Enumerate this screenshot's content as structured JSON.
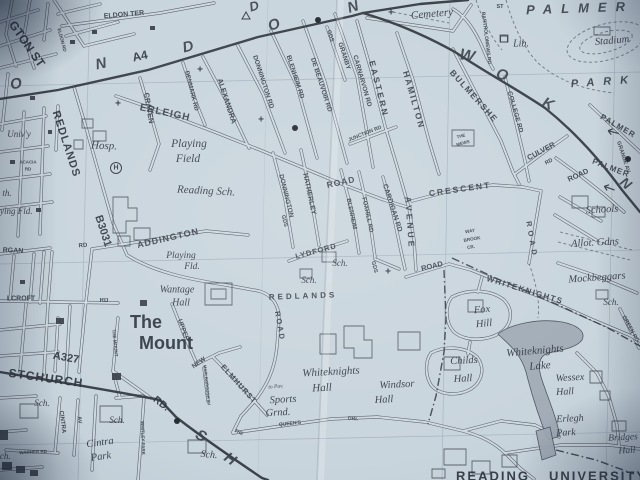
{
  "map": {
    "kind": "paper-street-atlas-photo",
    "area": "Reading - Whiteknights / University district",
    "colors": {
      "paper": "#c8d5de",
      "ink": "#3c434d",
      "bold_road": "#343a43",
      "lake": "#a9b5c1"
    },
    "road_numbers": [
      "A4",
      "B3031",
      "A327"
    ],
    "labels": [
      {
        "t": "GTON ST",
        "x": 27,
        "y": 44,
        "s": 12,
        "r": 55,
        "c": "plb"
      },
      {
        "t": "ELDON TER",
        "x": 124,
        "y": 15,
        "s": 7,
        "r": -5,
        "c": "st"
      },
      {
        "t": "ELDON RD",
        "x": 62,
        "y": 40,
        "s": 4.6,
        "r": 75,
        "c": "st"
      },
      {
        "t": "REDLANDS",
        "x": 66,
        "y": 144,
        "s": 11,
        "r": 72,
        "c": "plb",
        "ls": 1
      },
      {
        "t": "B3031",
        "x": 103,
        "y": 231,
        "s": 11,
        "r": 72,
        "c": "num"
      },
      {
        "t": "CRAVEN",
        "x": 149,
        "y": 108,
        "s": 7.5,
        "r": 80,
        "c": "st"
      },
      {
        "t": "ERLEIGH",
        "x": 165,
        "y": 113,
        "s": 10,
        "r": 12,
        "c": "st",
        "ls": 1
      },
      {
        "t": "DENMARK RD",
        "x": 191,
        "y": 91,
        "s": 6,
        "r": 76,
        "c": "st"
      },
      {
        "t": "ALEXANDRA",
        "x": 227,
        "y": 101,
        "s": 7.5,
        "r": 72,
        "c": "st"
      },
      {
        "t": "DONNINGTON RD",
        "x": 263,
        "y": 82,
        "s": 6.5,
        "r": 72,
        "c": "st"
      },
      {
        "t": "BLENHEIM RD",
        "x": 295,
        "y": 77,
        "s": 6.5,
        "r": 72,
        "c": "st"
      },
      {
        "t": "DE BEAUVOIR RD",
        "x": 321,
        "y": 85,
        "s": 6.5,
        "r": 72,
        "c": "st"
      },
      {
        "t": "GDS",
        "x": 330,
        "y": 36,
        "s": 5.5,
        "r": 72,
        "c": "st"
      },
      {
        "t": "GRANBY",
        "x": 344,
        "y": 56,
        "s": 6.5,
        "r": 72,
        "c": "st"
      },
      {
        "t": "CARNARVON RD",
        "x": 362,
        "y": 81,
        "s": 6.5,
        "r": 74,
        "c": "st"
      },
      {
        "t": "EASTERN",
        "x": 379,
        "y": 89,
        "s": 8.5,
        "r": 76,
        "c": "st",
        "ls": 2.5
      },
      {
        "t": "AVENUE",
        "x": 410,
        "y": 223,
        "s": 8.5,
        "r": 86,
        "c": "st",
        "ls": 3
      },
      {
        "t": "HAMILTON",
        "x": 414,
        "y": 100,
        "s": 8.5,
        "r": 74,
        "c": "st",
        "ls": 2
      },
      {
        "t": "JUNCTION RD",
        "x": 365,
        "y": 134,
        "s": 5.2,
        "r": -22,
        "c": "st"
      },
      {
        "t": "BULMERSHE",
        "x": 474,
        "y": 96,
        "s": 8.5,
        "r": 48,
        "c": "st",
        "ls": 1.5
      },
      {
        "t": "THE",
        "x": 461,
        "y": 136,
        "s": 4.4,
        "r": -15,
        "c": "st"
      },
      {
        "t": "MEWS",
        "x": 463,
        "y": 143,
        "s": 4.4,
        "r": -15,
        "c": "st"
      },
      {
        "t": "COLLEGE RD",
        "x": 515,
        "y": 112,
        "s": 6.5,
        "r": 74,
        "c": "st"
      },
      {
        "t": "ST",
        "x": 500,
        "y": 7,
        "s": 5.5,
        "r": 0,
        "c": "st"
      },
      {
        "t": "BARTHOLOMEWS RD",
        "x": 486,
        "y": 38,
        "s": 5,
        "r": 83,
        "c": "st"
      },
      {
        "t": "CULVER",
        "x": 541,
        "y": 151,
        "s": 7.5,
        "r": -28,
        "c": "st"
      },
      {
        "t": "RD",
        "x": 549,
        "y": 162,
        "s": 5.5,
        "r": -28,
        "c": "st"
      },
      {
        "t": "ROAD",
        "x": 578,
        "y": 175,
        "s": 7.5,
        "r": -25,
        "c": "st"
      },
      {
        "t": "CRESCENT",
        "x": 460,
        "y": 189,
        "s": 8.5,
        "r": -8,
        "c": "st",
        "ls": 2
      },
      {
        "t": "ROAD",
        "x": 432,
        "y": 266,
        "s": 7.5,
        "r": -14,
        "c": "st"
      },
      {
        "t": "ROAD",
        "x": 532,
        "y": 240,
        "s": 7.5,
        "r": 80,
        "c": "st",
        "ls": 4
      },
      {
        "t": "WHITEKNIGHTS",
        "x": 525,
        "y": 290,
        "s": 8,
        "r": 17,
        "c": "st",
        "ls": 1.5
      },
      {
        "t": "WAY",
        "x": 470,
        "y": 231,
        "s": 4.6,
        "r": -10,
        "c": "st"
      },
      {
        "t": "BROOK",
        "x": 472,
        "y": 239,
        "s": 4.6,
        "r": -10,
        "c": "st"
      },
      {
        "t": "CR.",
        "x": 471,
        "y": 247,
        "s": 4.6,
        "r": -10,
        "c": "st"
      },
      {
        "t": "ADDINGTON",
        "x": 168,
        "y": 238,
        "s": 9,
        "r": -13,
        "c": "st",
        "ls": 1
      },
      {
        "t": "RD",
        "x": 83,
        "y": 246,
        "s": 6,
        "r": -5,
        "c": "st"
      },
      {
        "t": "HATHERLEY",
        "x": 309,
        "y": 194,
        "s": 7,
        "r": 78,
        "c": "st"
      },
      {
        "t": "DONNINGTON",
        "x": 286,
        "y": 196,
        "s": 6.5,
        "r": 76,
        "c": "st"
      },
      {
        "t": "GDS",
        "x": 284,
        "y": 221,
        "s": 5.5,
        "r": 76,
        "c": "st"
      },
      {
        "t": "ROAD",
        "x": 341,
        "y": 182,
        "s": 8.5,
        "r": -12,
        "c": "st",
        "ls": 1
      },
      {
        "t": "BLENHEIM",
        "x": 351,
        "y": 214,
        "s": 6,
        "r": 78,
        "c": "st"
      },
      {
        "t": "FOXHILL RD",
        "x": 367,
        "y": 215,
        "s": 6,
        "r": 78,
        "c": "st"
      },
      {
        "t": "CARDIGAN RD",
        "x": 392,
        "y": 208,
        "s": 7,
        "r": 72,
        "c": "st"
      },
      {
        "t": "GDS",
        "x": 374,
        "y": 267,
        "s": 5.5,
        "r": 76,
        "c": "st"
      },
      {
        "t": "LYDFORD",
        "x": 316,
        "y": 251,
        "s": 7.5,
        "r": -15,
        "c": "st",
        "ls": 1
      },
      {
        "t": "REDLANDS",
        "x": 303,
        "y": 296,
        "s": 8,
        "r": -2,
        "c": "st",
        "ls": 3
      },
      {
        "t": "ROAD",
        "x": 280,
        "y": 326,
        "s": 7.5,
        "r": 80,
        "c": "st",
        "ls": 2
      },
      {
        "t": "UPPER",
        "x": 183,
        "y": 330,
        "s": 6.5,
        "r": 70,
        "c": "st"
      },
      {
        "t": "NEW",
        "x": 199,
        "y": 363,
        "s": 6.5,
        "r": -35,
        "c": "st"
      },
      {
        "t": "THE MOUNT",
        "x": 115,
        "y": 343,
        "s": 4.6,
        "r": 84,
        "c": "st"
      },
      {
        "t": "STCHURCH",
        "x": 46,
        "y": 378,
        "s": 12,
        "r": 8,
        "c": "plb",
        "ls": 1
      },
      {
        "t": "A327",
        "x": 66,
        "y": 358,
        "s": 11,
        "r": 10,
        "c": "num"
      },
      {
        "t": "RD.",
        "x": 161,
        "y": 404,
        "s": 10,
        "r": 38,
        "c": "plb"
      },
      {
        "t": "CINTRA",
        "x": 62,
        "y": 422,
        "s": 6,
        "r": 83,
        "c": "st"
      },
      {
        "t": "AV",
        "x": 79,
        "y": 420,
        "s": 5.5,
        "r": 83,
        "c": "st"
      },
      {
        "t": "WARNER RD",
        "x": 33,
        "y": 452,
        "s": 4.5,
        "r": -3,
        "c": "st"
      },
      {
        "t": "WHITLEY PARK",
        "x": 143,
        "y": 438,
        "s": 4.5,
        "r": 88,
        "c": "st"
      },
      {
        "t": "ELMHURST",
        "x": 239,
        "y": 384,
        "s": 7.5,
        "r": 48,
        "c": "st",
        "ls": 1
      },
      {
        "t": "MARLBOROUGH AV",
        "x": 207,
        "y": 385,
        "s": 4.2,
        "r": 84,
        "c": "st"
      },
      {
        "t": "QUEEN'S",
        "x": 290,
        "y": 424,
        "s": 5,
        "r": -6,
        "c": "st"
      },
      {
        "t": "DRI.",
        "x": 353,
        "y": 419,
        "s": 5,
        "r": 5,
        "c": "st"
      },
      {
        "t": "THE",
        "x": 239,
        "y": 432,
        "s": 4.5,
        "r": 25,
        "c": "st"
      },
      {
        "t": "GRANGE AV",
        "x": 623,
        "y": 157,
        "s": 5.5,
        "r": 72,
        "c": "st"
      },
      {
        "t": "PALMER",
        "x": 618,
        "y": 126,
        "s": 8,
        "r": 30,
        "c": "st",
        "ls": 1
      },
      {
        "t": "PALMER",
        "x": 611,
        "y": 168,
        "s": 8,
        "r": 21,
        "c": "st",
        "ls": 1
      },
      {
        "t": "RGAN",
        "x": 13,
        "y": 251,
        "s": 7,
        "r": 3,
        "c": "st"
      },
      {
        "t": "LCROFT",
        "x": 21,
        "y": 299,
        "s": 7,
        "r": 0,
        "c": "st"
      },
      {
        "t": "RD",
        "x": 104,
        "y": 301,
        "s": 6,
        "r": 0,
        "c": "st"
      },
      {
        "t": "ACACIA",
        "x": 28,
        "y": 162,
        "s": 4.4,
        "r": 0,
        "c": "st"
      },
      {
        "t": "RD",
        "x": 28,
        "y": 169,
        "s": 4.4,
        "r": 0,
        "c": "st"
      },
      {
        "t": "GREEN RD",
        "x": 630,
        "y": 329,
        "s": 5.5,
        "r": 62,
        "c": "st"
      },
      {
        "t": "O",
        "x": 16,
        "y": 84,
        "s": 15,
        "r": -12,
        "c": "big"
      },
      {
        "t": "N",
        "x": 101,
        "y": 64,
        "s": 15,
        "r": -12,
        "c": "big"
      },
      {
        "t": "A4",
        "x": 140,
        "y": 56,
        "s": 12,
        "r": -12,
        "c": "num"
      },
      {
        "t": "D",
        "x": 188,
        "y": 47,
        "s": 15,
        "r": -14,
        "c": "big"
      },
      {
        "t": "D",
        "x": 254,
        "y": 6,
        "s": 13,
        "r": -16,
        "c": "big"
      },
      {
        "t": "O",
        "x": 274,
        "y": 25,
        "s": 15,
        "r": -16,
        "c": "big"
      },
      {
        "t": "N",
        "x": 353,
        "y": 7,
        "s": 15,
        "r": -18,
        "c": "big"
      },
      {
        "t": "W",
        "x": 467,
        "y": 56,
        "s": 16,
        "r": 12,
        "c": "big"
      },
      {
        "t": "O",
        "x": 502,
        "y": 75,
        "s": 15,
        "r": 18,
        "c": "big"
      },
      {
        "t": "K",
        "x": 548,
        "y": 104,
        "s": 15,
        "r": 25,
        "c": "big"
      },
      {
        "t": "N",
        "x": 626,
        "y": 183,
        "s": 14,
        "r": 40,
        "c": "big"
      },
      {
        "t": "PALMER",
        "x": 580,
        "y": 8,
        "s": 13,
        "r": -2,
        "c": "big",
        "ls": 9
      },
      {
        "t": "PARK",
        "x": 604,
        "y": 82,
        "s": 11,
        "r": -4,
        "c": "big",
        "ls": 9
      },
      {
        "t": "S",
        "x": 201,
        "y": 436,
        "s": 15,
        "r": 30,
        "c": "big"
      },
      {
        "t": "H",
        "x": 230,
        "y": 459,
        "s": 15,
        "r": 35,
        "c": "big"
      },
      {
        "t": "Cemetery",
        "x": 432,
        "y": 14,
        "s": 11,
        "r": -5,
        "c": "pl"
      },
      {
        "t": "Lib.",
        "x": 521,
        "y": 44,
        "s": 10,
        "r": 0,
        "c": "pl"
      },
      {
        "t": "Stadium",
        "x": 612,
        "y": 41,
        "s": 10.5,
        "r": -5,
        "c": "pl"
      },
      {
        "t": "Hosp.",
        "x": 104,
        "y": 146,
        "s": 11,
        "r": 2,
        "c": "pl"
      },
      {
        "t": "Playing",
        "x": 189,
        "y": 144,
        "s": 11.5,
        "r": 0,
        "c": "pl"
      },
      {
        "t": "Field",
        "x": 188,
        "y": 159,
        "s": 11.5,
        "r": 0,
        "c": "pl"
      },
      {
        "t": "Reading Sch.",
        "x": 206,
        "y": 191,
        "s": 11,
        "r": 3,
        "c": "pl"
      },
      {
        "t": "Playing",
        "x": 181,
        "y": 256,
        "s": 9.5,
        "r": 0,
        "c": "pl"
      },
      {
        "t": "Fld.",
        "x": 192,
        "y": 267,
        "s": 9.5,
        "r": 0,
        "c": "pl"
      },
      {
        "t": "Wantage",
        "x": 177,
        "y": 290,
        "s": 10,
        "r": 0,
        "c": "pl"
      },
      {
        "t": "Hall",
        "x": 181,
        "y": 303,
        "s": 10,
        "r": 0,
        "c": "pl"
      },
      {
        "t": "The",
        "x": 146,
        "y": 322,
        "s": 18,
        "r": 0,
        "c": "plb"
      },
      {
        "t": "Mount",
        "x": 166,
        "y": 343,
        "s": 18,
        "r": 0,
        "c": "plb"
      },
      {
        "t": "Univ'y",
        "x": 19,
        "y": 134,
        "s": 9,
        "r": 0,
        "c": "pl"
      },
      {
        "t": "th.",
        "x": 7,
        "y": 193,
        "s": 9,
        "r": 0,
        "c": "pl"
      },
      {
        "t": "Playing Fld.",
        "x": 10,
        "y": 211,
        "s": 9,
        "r": 0,
        "c": "pl"
      },
      {
        "t": "Sch.",
        "x": 42,
        "y": 403,
        "s": 9,
        "r": 0,
        "c": "pl"
      },
      {
        "t": "Sch.",
        "x": 117,
        "y": 420,
        "s": 9,
        "r": 0,
        "c": "pl"
      },
      {
        "t": "Cintra",
        "x": 100,
        "y": 443,
        "s": 10.5,
        "r": -8,
        "c": "pl"
      },
      {
        "t": "Park",
        "x": 101,
        "y": 457,
        "s": 10.5,
        "r": -8,
        "c": "pl"
      },
      {
        "t": "Sch.",
        "x": 209,
        "y": 455,
        "s": 10,
        "r": 5,
        "c": "pl"
      },
      {
        "t": "Sch.",
        "x": 3,
        "y": 456,
        "s": 9,
        "r": 0,
        "c": "pl"
      },
      {
        "t": "Whiteknights",
        "x": 331,
        "y": 372,
        "s": 11,
        "r": -3,
        "c": "pl"
      },
      {
        "t": "Hall",
        "x": 322,
        "y": 388,
        "s": 11,
        "r": -3,
        "c": "pl"
      },
      {
        "t": "to Pav.",
        "x": 276,
        "y": 387,
        "s": 5.5,
        "r": -5,
        "c": "pl"
      },
      {
        "t": "Sports",
        "x": 283,
        "y": 400,
        "s": 10.5,
        "r": -3,
        "c": "pl"
      },
      {
        "t": "Grnd.",
        "x": 278,
        "y": 413,
        "s": 10.5,
        "r": -3,
        "c": "pl"
      },
      {
        "t": "Windsor",
        "x": 397,
        "y": 385,
        "s": 10.5,
        "r": -3,
        "c": "pl"
      },
      {
        "t": "Hall",
        "x": 384,
        "y": 400,
        "s": 10.5,
        "r": -3,
        "c": "pl"
      },
      {
        "t": "Fox",
        "x": 482,
        "y": 310,
        "s": 10.5,
        "r": -5,
        "c": "pl"
      },
      {
        "t": "Hill",
        "x": 484,
        "y": 324,
        "s": 10.5,
        "r": -5,
        "c": "pl"
      },
      {
        "t": "Childs",
        "x": 464,
        "y": 361,
        "s": 10.5,
        "r": -3,
        "c": "pl"
      },
      {
        "t": "Hall",
        "x": 463,
        "y": 379,
        "s": 10.5,
        "r": -3,
        "c": "pl"
      },
      {
        "t": "Whiteknights",
        "x": 535,
        "y": 351,
        "s": 11,
        "r": -5,
        "c": "pl"
      },
      {
        "t": "Lake",
        "x": 540,
        "y": 366,
        "s": 11,
        "r": -5,
        "c": "pl"
      },
      {
        "t": "Wessex",
        "x": 570,
        "y": 378,
        "s": 10,
        "r": -3,
        "c": "pl"
      },
      {
        "t": "Hall",
        "x": 565,
        "y": 392,
        "s": 10,
        "r": -3,
        "c": "pl"
      },
      {
        "t": "Erlegh",
        "x": 570,
        "y": 419,
        "s": 10,
        "r": -3,
        "c": "pl"
      },
      {
        "t": "Park",
        "x": 566,
        "y": 433,
        "s": 10,
        "r": -3,
        "c": "pl"
      },
      {
        "t": "Bridges",
        "x": 623,
        "y": 438,
        "s": 9.5,
        "r": -3,
        "c": "pl"
      },
      {
        "t": "Hall",
        "x": 627,
        "y": 451,
        "s": 9.5,
        "r": -3,
        "c": "pl"
      },
      {
        "t": "READING",
        "x": 493,
        "y": 476,
        "s": 13,
        "r": 0,
        "c": "plb",
        "ls": 2
      },
      {
        "t": "UNIVERSITY",
        "x": 598,
        "y": 476,
        "s": 13,
        "r": 0,
        "c": "plb",
        "ls": 2
      },
      {
        "t": "Mockbeggars",
        "x": 597,
        "y": 278,
        "s": 10.5,
        "r": -4,
        "c": "pl"
      },
      {
        "t": "Sch.",
        "x": 611,
        "y": 302,
        "s": 9,
        "r": 0,
        "c": "pl"
      },
      {
        "t": "Schools",
        "x": 602,
        "y": 210,
        "s": 10.5,
        "r": -3,
        "c": "pl"
      },
      {
        "t": "Allot. Gdns",
        "x": 595,
        "y": 243,
        "s": 10.5,
        "r": -3,
        "c": "pl"
      },
      {
        "t": "Sch.",
        "x": 340,
        "y": 263,
        "s": 9,
        "r": 0,
        "c": "pl"
      },
      {
        "t": "Sch.",
        "x": 309,
        "y": 280,
        "s": 9,
        "r": 0,
        "c": "pl"
      }
    ],
    "symbols": [
      {
        "k": "cross",
        "x": 118,
        "y": 104
      },
      {
        "k": "cross",
        "x": 200,
        "y": 70
      },
      {
        "k": "cross",
        "x": 261,
        "y": 120
      },
      {
        "k": "cross",
        "x": 388,
        "y": 272
      },
      {
        "k": "cross",
        "x": 391,
        "y": 13
      },
      {
        "k": "dot",
        "x": 318,
        "y": 20
      },
      {
        "k": "dot",
        "x": 295,
        "y": 128
      },
      {
        "k": "dot",
        "x": 177,
        "y": 421
      },
      {
        "k": "dot",
        "x": 628,
        "y": 159
      },
      {
        "k": "hospital",
        "x": 116,
        "y": 168
      },
      {
        "k": "triangle",
        "x": 246,
        "y": 16
      },
      {
        "k": "square",
        "x": 504,
        "y": 39
      },
      {
        "k": "arrow",
        "x": 609,
        "y": 188,
        "r": 200
      },
      {
        "k": "arrow",
        "x": 613,
        "y": 132,
        "r": 195
      }
    ]
  }
}
